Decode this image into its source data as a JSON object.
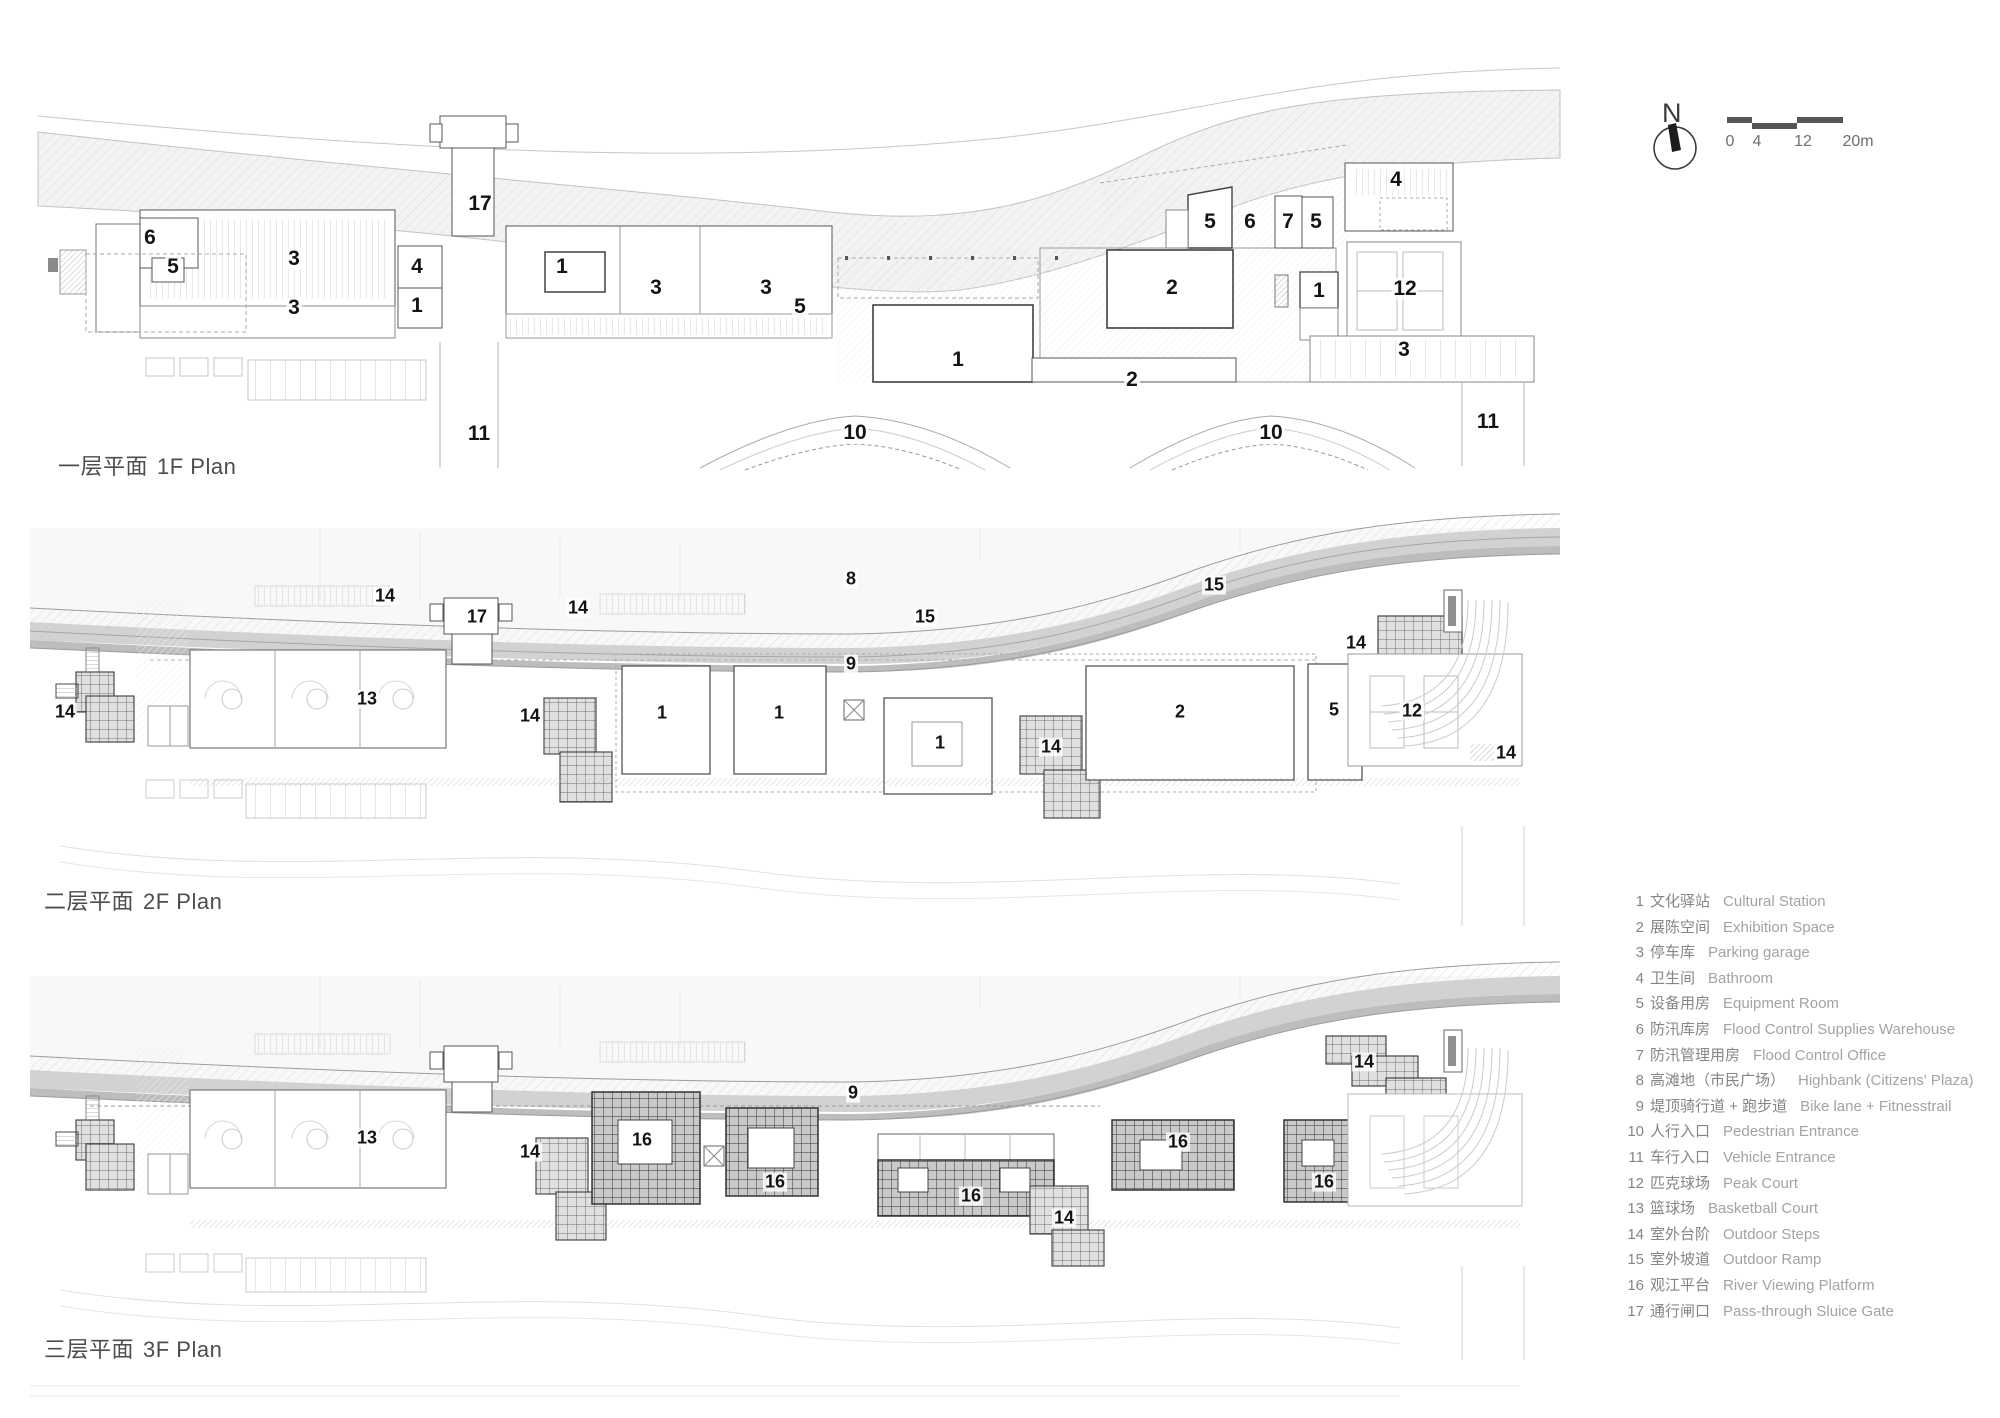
{
  "north": {
    "label": "N"
  },
  "scale_bar": {
    "ticks": [
      "0",
      "4",
      "12",
      "20m"
    ]
  },
  "plans": [
    {
      "id": "1f",
      "title_zh": "一层平面",
      "title_en": "1F Plan",
      "labels": [
        {
          "n": "17",
          "x": 480,
          "y": 204
        },
        {
          "n": "6",
          "x": 150,
          "y": 238
        },
        {
          "n": "5",
          "x": 173,
          "y": 267
        },
        {
          "n": "3",
          "x": 294,
          "y": 259
        },
        {
          "n": "3",
          "x": 294,
          "y": 308
        },
        {
          "n": "4",
          "x": 417,
          "y": 267
        },
        {
          "n": "1",
          "x": 417,
          "y": 306
        },
        {
          "n": "1",
          "x": 562,
          "y": 267
        },
        {
          "n": "3",
          "x": 656,
          "y": 288
        },
        {
          "n": "3",
          "x": 766,
          "y": 288
        },
        {
          "n": "5",
          "x": 800,
          "y": 307
        },
        {
          "n": "1",
          "x": 958,
          "y": 360
        },
        {
          "n": "2",
          "x": 1172,
          "y": 288
        },
        {
          "n": "2",
          "x": 1132,
          "y": 380
        },
        {
          "n": "5",
          "x": 1210,
          "y": 222
        },
        {
          "n": "6",
          "x": 1250,
          "y": 222
        },
        {
          "n": "7",
          "x": 1288,
          "y": 222
        },
        {
          "n": "5",
          "x": 1316,
          "y": 222
        },
        {
          "n": "1",
          "x": 1319,
          "y": 291
        },
        {
          "n": "4",
          "x": 1396,
          "y": 180
        },
        {
          "n": "12",
          "x": 1405,
          "y": 289
        },
        {
          "n": "3",
          "x": 1404,
          "y": 350
        },
        {
          "n": "11",
          "x": 479,
          "y": 434
        },
        {
          "n": "10",
          "x": 855,
          "y": 433
        },
        {
          "n": "10",
          "x": 1271,
          "y": 433
        },
        {
          "n": "11",
          "x": 1488,
          "y": 422
        }
      ]
    },
    {
      "id": "2f",
      "title_zh": "二层平面",
      "title_en": "2F Plan",
      "labels": [
        {
          "n": "14",
          "x": 385,
          "y": 596
        },
        {
          "n": "17",
          "x": 477,
          "y": 617
        },
        {
          "n": "14",
          "x": 578,
          "y": 608
        },
        {
          "n": "14",
          "x": 65,
          "y": 712
        },
        {
          "n": "13",
          "x": 367,
          "y": 699
        },
        {
          "n": "14",
          "x": 530,
          "y": 716
        },
        {
          "n": "1",
          "x": 662,
          "y": 713
        },
        {
          "n": "1",
          "x": 779,
          "y": 713
        },
        {
          "n": "8",
          "x": 851,
          "y": 579
        },
        {
          "n": "15",
          "x": 925,
          "y": 617
        },
        {
          "n": "15",
          "x": 1214,
          "y": 585
        },
        {
          "n": "9",
          "x": 851,
          "y": 664
        },
        {
          "n": "1",
          "x": 940,
          "y": 743
        },
        {
          "n": "14",
          "x": 1051,
          "y": 747
        },
        {
          "n": "2",
          "x": 1180,
          "y": 712
        },
        {
          "n": "5",
          "x": 1334,
          "y": 710
        },
        {
          "n": "14",
          "x": 1356,
          "y": 643
        },
        {
          "n": "12",
          "x": 1412,
          "y": 711
        },
        {
          "n": "14",
          "x": 1506,
          "y": 753
        }
      ]
    },
    {
      "id": "3f",
      "title_zh": "三层平面",
      "title_en": "3F Plan",
      "labels": [
        {
          "n": "9",
          "x": 853,
          "y": 1093
        },
        {
          "n": "13",
          "x": 367,
          "y": 1138
        },
        {
          "n": "14",
          "x": 530,
          "y": 1152
        },
        {
          "n": "16",
          "x": 642,
          "y": 1140
        },
        {
          "n": "16",
          "x": 775,
          "y": 1182
        },
        {
          "n": "16",
          "x": 971,
          "y": 1196
        },
        {
          "n": "14",
          "x": 1064,
          "y": 1218
        },
        {
          "n": "16",
          "x": 1178,
          "y": 1142
        },
        {
          "n": "16",
          "x": 1324,
          "y": 1182
        },
        {
          "n": "14",
          "x": 1364,
          "y": 1062
        }
      ]
    }
  ],
  "legend": {
    "items": [
      {
        "num": "1",
        "zh": "文化驿站",
        "en": "Cultural Station"
      },
      {
        "num": "2",
        "zh": "展陈空间",
        "en": "Exhibition Space"
      },
      {
        "num": "3",
        "zh": "停车库",
        "en": "Parking garage"
      },
      {
        "num": "4",
        "zh": "卫生间",
        "en": "Bathroom"
      },
      {
        "num": "5",
        "zh": "设备用房",
        "en": "Equipment Room"
      },
      {
        "num": "6",
        "zh": "防汛库房",
        "en": "Flood Control Supplies Warehouse"
      },
      {
        "num": "7",
        "zh": "防汛管理用房",
        "en": "Flood Control Office"
      },
      {
        "num": "8",
        "zh": "高滩地（市民广场）",
        "en": "Highbank (Citizens' Plaza)"
      },
      {
        "num": "9",
        "zh": "堤顶骑行道 + 跑步道",
        "en": "Bike lane + Fitnesstrail"
      },
      {
        "num": "10",
        "zh": "人行入口",
        "en": "Pedestrian Entrance"
      },
      {
        "num": "11",
        "zh": "车行入口",
        "en": "Vehicle Entrance"
      },
      {
        "num": "12",
        "zh": "匹克球场",
        "en": "Peak Court"
      },
      {
        "num": "13",
        "zh": "篮球场",
        "en": "Basketball Court"
      },
      {
        "num": "14",
        "zh": "室外台阶",
        "en": "Outdoor Steps"
      },
      {
        "num": "15",
        "zh": "室外坡道",
        "en": "Outdoor Ramp"
      },
      {
        "num": "16",
        "zh": "观江平台",
        "en": "River Viewing Platform"
      },
      {
        "num": "17",
        "zh": "通行闸口",
        "en": "Pass-through Sluice Gate"
      }
    ]
  },
  "colors": {
    "label_text": "#141414",
    "legend_zh": "#858585",
    "legend_en": "#a3a3a3",
    "road_band": "#d2d2d2",
    "road_stripe": "#bdbdbd",
    "dark_platform_grid": "#4d4d4d"
  }
}
